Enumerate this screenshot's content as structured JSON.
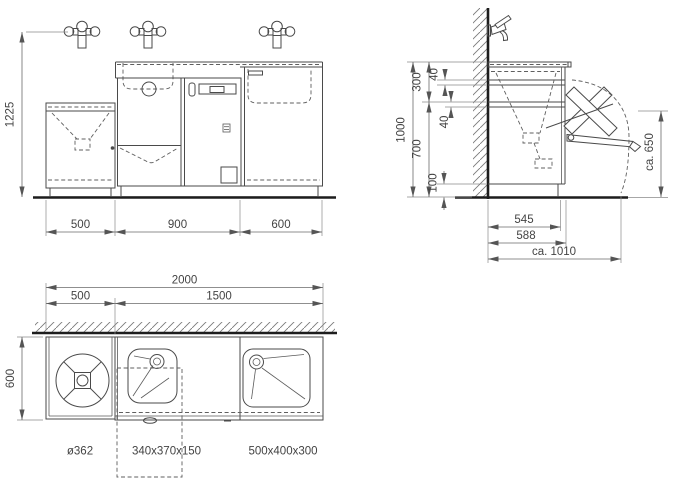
{
  "drawing": {
    "type": "technical-installation-drawing",
    "colors": {
      "line": "#4a4a4a",
      "dimension": "#6a6a6a",
      "heavy_line": "#1d1d1d",
      "background": "#ffffff"
    },
    "icons": {
      "faucet-front-icon": "two-handle wall mixer tap seen from front (circles + stem)",
      "faucet-side-icon": "wall-mounted tap seen from side (lever + spout)",
      "wall-hatch": "diagonal section hatching",
      "fold-out-flap": "fold-down working flap with swing arc"
    }
  },
  "views": {
    "front": {
      "dim_height": "1225",
      "dim_widths": [
        "500",
        "900",
        "600"
      ]
    },
    "side": {
      "dim_total_height": "1000",
      "dim_upper": "300",
      "dim_rail_top": "40",
      "dim_rail_mid": "40",
      "dim_lower": "700",
      "dim_plinth": "100",
      "dim_flap_height": "ca. 650",
      "dim_depth_inner": "545",
      "dim_depth_outer": "588",
      "dim_depth_total": "ca. 1010"
    },
    "plan": {
      "dim_total_width": "2000",
      "dim_left_width": "500",
      "dim_right_width": "1500",
      "dim_depth": "600",
      "label_round_outlet": "ø362",
      "label_center_basin": "340x370x150",
      "label_right_basin": "500x400x300"
    }
  }
}
